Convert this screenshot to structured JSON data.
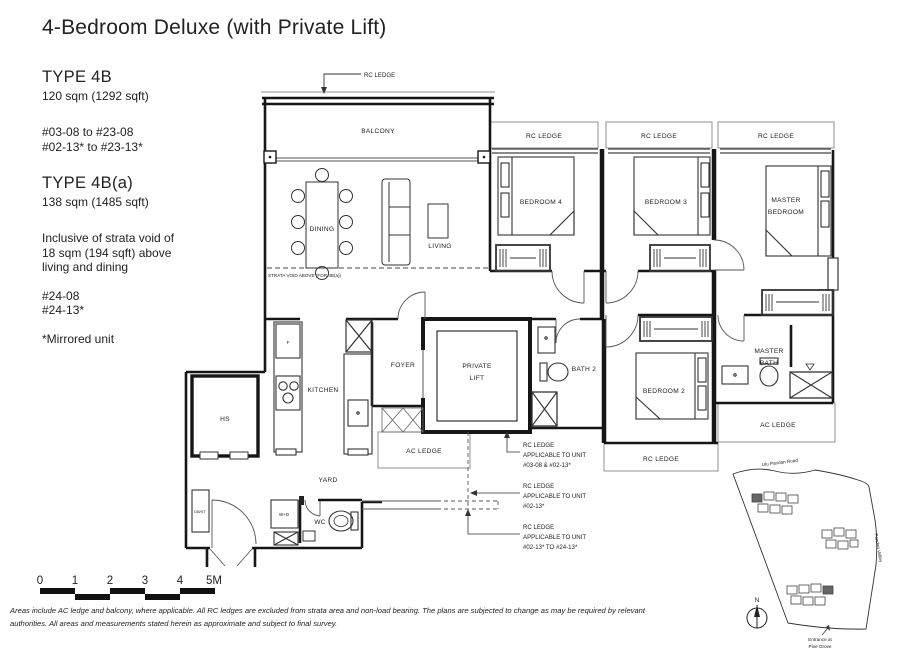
{
  "title": "4-Bedroom Deluxe (with Private Lift)",
  "types": [
    {
      "name": "TYPE 4B",
      "area": "120 sqm (1292 sqft)",
      "units_line1": "#03-08  to #23-08",
      "units_line2": "#02-13* to #23-13*"
    },
    {
      "name": "TYPE 4B(a)",
      "area": "138 sqm (1485 sqft)",
      "note_line1": "Inclusive of strata void of",
      "note_line2": "18 sqm (194 sqft) above",
      "note_line3": "living and dining",
      "units_line1": "#24-08",
      "units_line2": "#24-13*"
    }
  ],
  "mirrored_note": "*Mirrored unit",
  "labels": {
    "rc_ledge": "RC LEDGE",
    "ac_ledge": "AC LEDGE",
    "balcony": "BALCONY",
    "dining": "DINING",
    "living": "LIVING",
    "bedroom4": "BEDROOM 4",
    "bedroom3": "BEDROOM 3",
    "master_line1": "MASTER",
    "master_line2": "BEDROOM",
    "kitchen": "KITCHEN",
    "foyer": "FOYER",
    "lift_line1": "PRIVATE",
    "lift_line2": "LIFT",
    "bath2": "BATH 2",
    "bedroom2": "BEDROOM 2",
    "master_bath_line1": "MASTER",
    "master_bath_line2": "BATH",
    "hs": "HS",
    "yard": "YARD",
    "wc": "WC",
    "wd": "W+D",
    "dbst": "DB/ST",
    "fridge": "F",
    "strata_void": "STRATA VOID ABOVE (FOR 4B(a))"
  },
  "rc_notes": [
    {
      "line1": "RC LEDGE",
      "line2": "APPLICABLE TO UNIT",
      "line3": "#03-08 & #02-13*"
    },
    {
      "line1": "RC LEDGE",
      "line2": "APPLICABLE TO UNIT",
      "line3": "#02-13*"
    },
    {
      "line1": "RC LEDGE",
      "line2": "APPLICABLE TO UNIT",
      "line3": "#02-13* TO #24-13*"
    }
  ],
  "site_map": {
    "road_top": "Ulu Pandan Road",
    "road_right": "Pandan Valley",
    "entrance_line1": "Entrance at",
    "entrance_line2": "Pine Grove",
    "north": "N"
  },
  "scale_bar": {
    "t0": "0",
    "t1": "1",
    "t2": "2",
    "t3": "3",
    "t4": "4",
    "t5": "5M"
  },
  "disclaimer": {
    "line1": "Areas include AC ledge and balcony, where applicable. All RC ledges are excluded from strata area and non-load bearing. The plans are subjected to change as may be required by relevant",
    "line2": "authorities. All areas and measurements stated herein as approximate and subject to final survey."
  }
}
